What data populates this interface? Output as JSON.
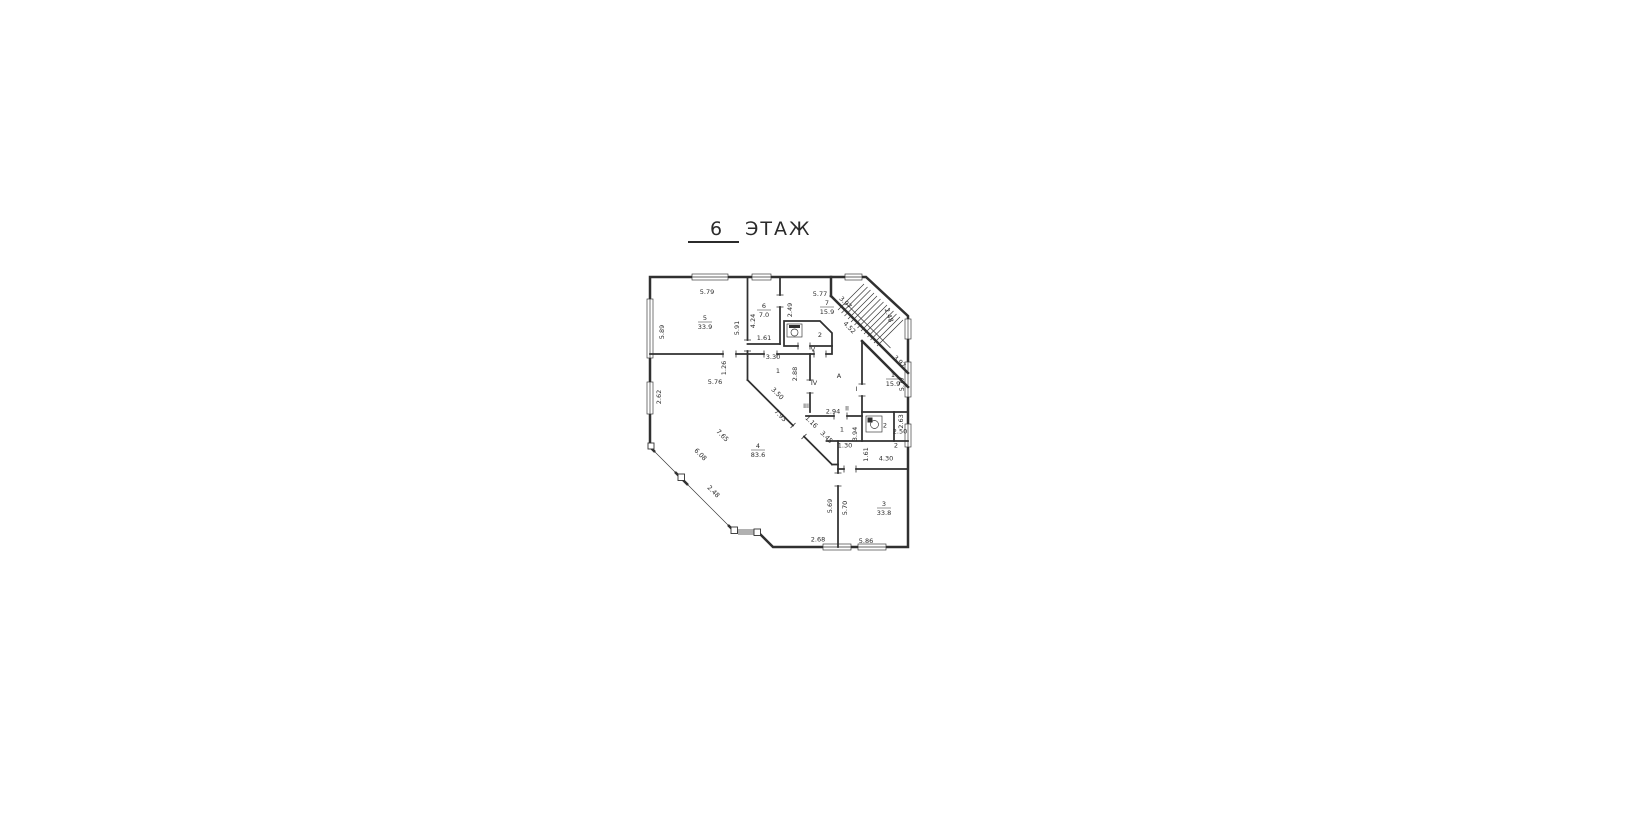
{
  "title": {
    "number": "6",
    "word": "ЭТАЖ"
  },
  "colors": {
    "background": "#ffffff",
    "line": "#303030",
    "text": "#2b2b2b"
  },
  "plan": {
    "rooms": [
      {
        "name": "room-5",
        "num": "5",
        "area": "33.9",
        "x": 194,
        "y": 214
      },
      {
        "name": "room-6",
        "num": "6",
        "area": "7.0",
        "x": 312,
        "y": 190
      },
      {
        "name": "room-7",
        "num": "7",
        "area": "15.9",
        "x": 438,
        "y": 184
      },
      {
        "name": "room-1-right",
        "num": "1",
        "area": "15.9",
        "x": 570,
        "y": 328
      },
      {
        "name": "room-4",
        "num": "4",
        "area": "83.6",
        "x": 300,
        "y": 470
      },
      {
        "name": "room-3",
        "num": "3",
        "area": "33.8",
        "x": 552,
        "y": 586
      }
    ],
    "labels": [
      {
        "t": "5.79",
        "x": 198,
        "y": 162
      },
      {
        "t": "5.89",
        "x": 112,
        "y": 238,
        "r": -90
      },
      {
        "t": "5.91",
        "x": 262,
        "y": 230,
        "r": -90
      },
      {
        "t": "4.24",
        "x": 294,
        "y": 216,
        "r": -90
      },
      {
        "t": "1.61",
        "x": 312,
        "y": 254
      },
      {
        "t": "2.49",
        "x": 368,
        "y": 194,
        "r": -90
      },
      {
        "t": "5.77",
        "x": 424,
        "y": 166
      },
      {
        "t": "3.97",
        "x": 472,
        "y": 182,
        "r": 45
      },
      {
        "t": "2.48",
        "x": 558,
        "y": 206,
        "r": 70
      },
      {
        "t": "4.52",
        "x": 480,
        "y": 232,
        "r": 45
      },
      {
        "t": "2",
        "x": 424,
        "y": 248
      },
      {
        "t": "V",
        "x": 410,
        "y": 277
      },
      {
        "t": "1.26",
        "x": 236,
        "y": 310,
        "r": -90
      },
      {
        "t": "3.30",
        "x": 330,
        "y": 292
      },
      {
        "t": "1",
        "x": 340,
        "y": 320
      },
      {
        "t": "2.88",
        "x": 378,
        "y": 322,
        "r": -90
      },
      {
        "t": "3.50",
        "x": 336,
        "y": 364,
        "r": 45
      },
      {
        "t": "IV",
        "x": 412,
        "y": 344
      },
      {
        "t": "III",
        "x": 396,
        "y": 390
      },
      {
        "t": "5.76",
        "x": 214,
        "y": 342
      },
      {
        "t": "2.62",
        "x": 106,
        "y": 368,
        "r": -90
      },
      {
        "t": "A",
        "x": 462,
        "y": 330
      },
      {
        "t": "3.97",
        "x": 580,
        "y": 300,
        "r": 45
      },
      {
        "t": "5.77",
        "x": 592,
        "y": 342,
        "r": -90
      },
      {
        "t": "I",
        "x": 497,
        "y": 356
      },
      {
        "t": "II",
        "x": 478,
        "y": 395
      },
      {
        "t": "2.94",
        "x": 450,
        "y": 401
      },
      {
        "t": "1.16",
        "x": 404,
        "y": 421,
        "r": 45
      },
      {
        "t": "3.45",
        "x": 434,
        "y": 451,
        "r": 45
      },
      {
        "t": "1",
        "x": 468,
        "y": 437
      },
      {
        "t": "3.94",
        "x": 498,
        "y": 442,
        "r": -90
      },
      {
        "t": "1.30",
        "x": 474,
        "y": 469
      },
      {
        "t": "1.61",
        "x": 520,
        "y": 483,
        "r": -90
      },
      {
        "t": "2",
        "x": 576,
        "y": 469
      },
      {
        "t": "4.30",
        "x": 556,
        "y": 495
      },
      {
        "t": "2.63",
        "x": 590,
        "y": 417,
        "r": -90
      },
      {
        "t": "2.50",
        "x": 584,
        "y": 441
      },
      {
        "t": "2",
        "x": 554,
        "y": 429
      },
      {
        "t": "7.93",
        "x": 342,
        "y": 408,
        "r": 45
      },
      {
        "t": "7.65",
        "x": 226,
        "y": 448,
        "r": 45
      },
      {
        "t": "6.08",
        "x": 182,
        "y": 486,
        "r": 45
      },
      {
        "t": "2.48",
        "x": 208,
        "y": 560,
        "r": 45
      },
      {
        "t": "5.69",
        "x": 448,
        "y": 586,
        "r": -90
      },
      {
        "t": "5.70",
        "x": 478,
        "y": 590,
        "r": -90
      },
      {
        "t": "2.68",
        "x": 420,
        "y": 657
      },
      {
        "t": "5.86",
        "x": 516,
        "y": 660
      }
    ]
  }
}
